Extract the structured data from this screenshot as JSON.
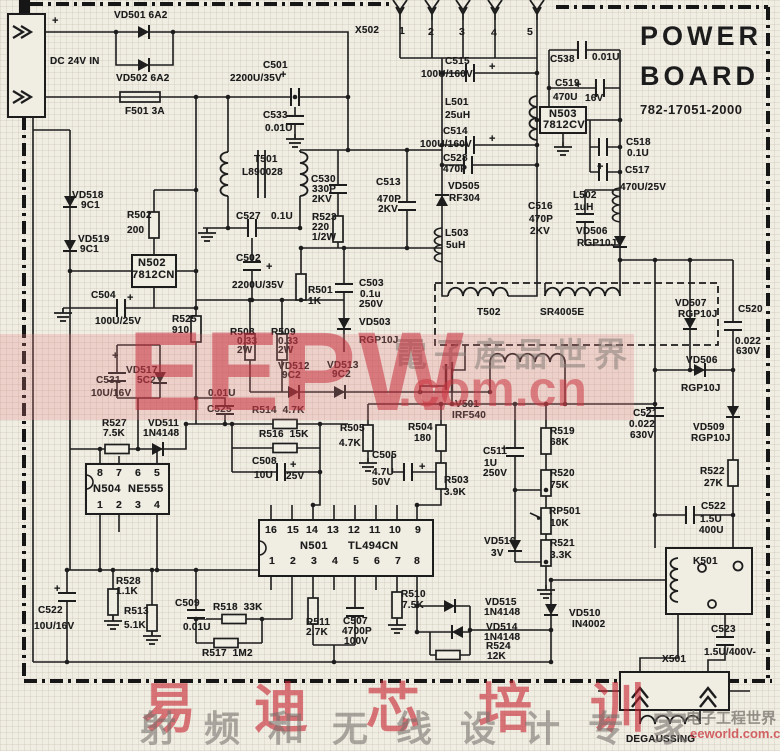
{
  "colors": {
    "paper": "#f0ede3",
    "ink": "#1d1d1d",
    "watermark_red": "#c52a3a",
    "watermark_pink": "rgba(226,128,128,0.26)"
  },
  "title_block": {
    "line1": "POWER",
    "line2": "BOARD",
    "part_number": "782-17051-2000"
  },
  "watermarks": {
    "center": {
      "brand": "EEPW",
      "cjk": "電子産品世界",
      "domain": ".com.cn"
    },
    "bottom": {
      "brand_cjk": "易迪芯培训",
      "slogan_cjk": "射频和无线设计专家",
      "site_cjk": "电子工程世界",
      "site_url": "eeworld.com.cn"
    }
  },
  "schematic": {
    "labels": [
      {
        "t": "+",
        "x": 52,
        "y": 16,
        "c": "plus"
      },
      {
        "t": "VD501 6A2",
        "x": 114,
        "y": 11
      },
      {
        "t": "DC 24V IN",
        "x": 50,
        "y": 57
      },
      {
        "t": "VD502 6A2",
        "x": 116,
        "y": 74
      },
      {
        "t": "F501 3A",
        "x": 125,
        "y": 107
      },
      {
        "t": "X502",
        "x": 355,
        "y": 26
      },
      {
        "t": "1",
        "x": 399,
        "y": 26,
        "c": "p"
      },
      {
        "t": "2",
        "x": 428,
        "y": 27,
        "c": "p"
      },
      {
        "t": "3",
        "x": 459,
        "y": 27,
        "c": "p"
      },
      {
        "t": "4",
        "x": 491,
        "y": 28,
        "c": "p"
      },
      {
        "t": "5",
        "x": 527,
        "y": 27,
        "c": "p"
      },
      {
        "t": "C538",
        "x": 550,
        "y": 55
      },
      {
        "t": "0.01U",
        "x": 592,
        "y": 53
      },
      {
        "t": "C519",
        "x": 555,
        "y": 79
      },
      {
        "t": "+",
        "x": 575,
        "y": 80,
        "c": "plus"
      },
      {
        "t": "470U",
        "x": 553,
        "y": 93
      },
      {
        "t": "16V",
        "x": 585,
        "y": 94
      },
      {
        "t": "N503",
        "x": 549,
        "y": 109,
        "c": "ic"
      },
      {
        "t": "7812CV",
        "x": 543,
        "y": 120,
        "c": "ic"
      },
      {
        "t": "C518",
        "x": 626,
        "y": 138
      },
      {
        "t": "0.1U",
        "x": 627,
        "y": 149
      },
      {
        "t": "C517",
        "x": 625,
        "y": 166
      },
      {
        "t": "+",
        "x": 597,
        "y": 162,
        "c": "plus"
      },
      {
        "t": "470U/25V",
        "x": 620,
        "y": 183
      },
      {
        "t": "C515",
        "x": 445,
        "y": 57
      },
      {
        "t": "100U/160V",
        "x": 421,
        "y": 70
      },
      {
        "t": "+",
        "x": 489,
        "y": 62,
        "c": "plus"
      },
      {
        "t": "L501",
        "x": 445,
        "y": 98
      },
      {
        "t": "25uH",
        "x": 445,
        "y": 111
      },
      {
        "t": "C514",
        "x": 443,
        "y": 127
      },
      {
        "t": "100U/160V",
        "x": 420,
        "y": 140
      },
      {
        "t": "+",
        "x": 489,
        "y": 134,
        "c": "plus"
      },
      {
        "t": "C528",
        "x": 443,
        "y": 154
      },
      {
        "t": "470P",
        "x": 443,
        "y": 165
      },
      {
        "t": "VD505",
        "x": 448,
        "y": 182
      },
      {
        "t": "RF304",
        "x": 449,
        "y": 194
      },
      {
        "t": "L503",
        "x": 445,
        "y": 229
      },
      {
        "t": "5uH",
        "x": 446,
        "y": 241
      },
      {
        "t": "C516",
        "x": 528,
        "y": 202
      },
      {
        "t": "470P",
        "x": 529,
        "y": 215
      },
      {
        "t": "2KV",
        "x": 530,
        "y": 227
      },
      {
        "t": "L502",
        "x": 573,
        "y": 191
      },
      {
        "t": "1uH",
        "x": 574,
        "y": 203
      },
      {
        "t": "VD506",
        "x": 576,
        "y": 227
      },
      {
        "t": "RGP10J",
        "x": 577,
        "y": 239
      },
      {
        "t": "C501",
        "x": 263,
        "y": 61
      },
      {
        "t": "2200U/35V",
        "x": 230,
        "y": 74
      },
      {
        "t": "+",
        "x": 280,
        "y": 70,
        "c": "plus"
      },
      {
        "t": "C533",
        "x": 263,
        "y": 111
      },
      {
        "t": "0.01U",
        "x": 265,
        "y": 124
      },
      {
        "t": "T501",
        "x": 254,
        "y": 155
      },
      {
        "t": "L890028",
        "x": 242,
        "y": 168
      },
      {
        "t": "C530",
        "x": 311,
        "y": 175
      },
      {
        "t": "330P",
        "x": 312,
        "y": 185
      },
      {
        "t": "2KV",
        "x": 312,
        "y": 195
      },
      {
        "t": "C513",
        "x": 376,
        "y": 178
      },
      {
        "t": "470P",
        "x": 377,
        "y": 195
      },
      {
        "t": "2KV",
        "x": 378,
        "y": 205
      },
      {
        "t": "VD518",
        "x": 72,
        "y": 191
      },
      {
        "t": "9C1",
        "x": 81,
        "y": 201
      },
      {
        "t": "VD519",
        "x": 78,
        "y": 235
      },
      {
        "t": "9C1",
        "x": 80,
        "y": 245
      },
      {
        "t": "R502",
        "x": 127,
        "y": 211
      },
      {
        "t": "200",
        "x": 127,
        "y": 226
      },
      {
        "t": "C527",
        "x": 236,
        "y": 212
      },
      {
        "t": "0.1U",
        "x": 271,
        "y": 212
      },
      {
        "t": "R523",
        "x": 312,
        "y": 213
      },
      {
        "t": "220",
        "x": 312,
        "y": 223
      },
      {
        "t": "1/2W",
        "x": 312,
        "y": 233
      },
      {
        "t": "N502",
        "x": 138,
        "y": 258,
        "c": "ic"
      },
      {
        "t": "7812CN",
        "x": 132,
        "y": 270,
        "c": "ic"
      },
      {
        "t": "C502",
        "x": 236,
        "y": 254
      },
      {
        "t": "+",
        "x": 266,
        "y": 262,
        "c": "plus"
      },
      {
        "t": "2200U/35V",
        "x": 232,
        "y": 281
      },
      {
        "t": "R501",
        "x": 308,
        "y": 286
      },
      {
        "t": "1K",
        "x": 308,
        "y": 297
      },
      {
        "t": "C503",
        "x": 359,
        "y": 279
      },
      {
        "t": "0.1u",
        "x": 360,
        "y": 290
      },
      {
        "t": "250V",
        "x": 359,
        "y": 300
      },
      {
        "t": "C504",
        "x": 91,
        "y": 291
      },
      {
        "t": "+",
        "x": 127,
        "y": 293,
        "c": "plus"
      },
      {
        "t": "100U/25V",
        "x": 95,
        "y": 317
      },
      {
        "t": "R525",
        "x": 172,
        "y": 315
      },
      {
        "t": "910",
        "x": 172,
        "y": 326
      },
      {
        "t": "VD503",
        "x": 359,
        "y": 318
      },
      {
        "t": "RGP10J",
        "x": 359,
        "y": 336
      },
      {
        "t": "T502",
        "x": 477,
        "y": 308
      },
      {
        "t": "SR4005E",
        "x": 540,
        "y": 308
      },
      {
        "t": "R508",
        "x": 230,
        "y": 328
      },
      {
        "t": "0.33",
        "x": 237,
        "y": 337
      },
      {
        "t": "2W",
        "x": 237,
        "y": 346
      },
      {
        "t": "R509",
        "x": 271,
        "y": 328
      },
      {
        "t": "0.33",
        "x": 278,
        "y": 337
      },
      {
        "t": "2W",
        "x": 278,
        "y": 346
      },
      {
        "t": "VD512",
        "x": 278,
        "y": 362
      },
      {
        "t": "9C2",
        "x": 282,
        "y": 371
      },
      {
        "t": "VD513",
        "x": 327,
        "y": 361
      },
      {
        "t": "9C2",
        "x": 332,
        "y": 370
      },
      {
        "t": "C531",
        "x": 96,
        "y": 376
      },
      {
        "t": "10U/16V",
        "x": 91,
        "y": 389
      },
      {
        "t": "+",
        "x": 112,
        "y": 351,
        "c": "plus"
      },
      {
        "t": "VD517",
        "x": 126,
        "y": 366
      },
      {
        "t": "5C2",
        "x": 137,
        "y": 376
      },
      {
        "t": "0.01U",
        "x": 208,
        "y": 389
      },
      {
        "t": "C525",
        "x": 207,
        "y": 405
      },
      {
        "t": "R514  4.7K",
        "x": 252,
        "y": 406
      },
      {
        "t": "R516  15K",
        "x": 259,
        "y": 430
      },
      {
        "t": "V501",
        "x": 455,
        "y": 400
      },
      {
        "t": "IRF540",
        "x": 452,
        "y": 411
      },
      {
        "t": "R527",
        "x": 102,
        "y": 419
      },
      {
        "t": "7.5K",
        "x": 103,
        "y": 429
      },
      {
        "t": "VD511",
        "x": 148,
        "y": 419
      },
      {
        "t": "1N4148",
        "x": 143,
        "y": 429
      },
      {
        "t": "R505",
        "x": 340,
        "y": 424
      },
      {
        "t": "4.7K",
        "x": 339,
        "y": 439
      },
      {
        "t": "R504",
        "x": 408,
        "y": 423
      },
      {
        "t": "180",
        "x": 414,
        "y": 434
      },
      {
        "t": "C505",
        "x": 372,
        "y": 451
      },
      {
        "t": "4.7U",
        "x": 372,
        "y": 468
      },
      {
        "t": "50V",
        "x": 372,
        "y": 478
      },
      {
        "t": "+",
        "x": 419,
        "y": 462,
        "c": "plus"
      },
      {
        "t": "R503",
        "x": 444,
        "y": 476
      },
      {
        "t": "3.9K",
        "x": 444,
        "y": 488
      },
      {
        "t": "C508",
        "x": 252,
        "y": 457
      },
      {
        "t": "+",
        "x": 290,
        "y": 460,
        "c": "plus"
      },
      {
        "t": "10U",
        "x": 254,
        "y": 471
      },
      {
        "t": "25V",
        "x": 286,
        "y": 472
      },
      {
        "t": "8",
        "x": 97,
        "y": 468,
        "c": "p"
      },
      {
        "t": "7",
        "x": 116,
        "y": 468,
        "c": "p"
      },
      {
        "t": "6",
        "x": 135,
        "y": 468,
        "c": "p"
      },
      {
        "t": "5",
        "x": 154,
        "y": 468,
        "c": "p"
      },
      {
        "t": "N504",
        "x": 93,
        "y": 484,
        "c": "ic"
      },
      {
        "t": "NE555",
        "x": 128,
        "y": 484,
        "c": "ic"
      },
      {
        "t": "1",
        "x": 97,
        "y": 500,
        "c": "p"
      },
      {
        "t": "2",
        "x": 116,
        "y": 500,
        "c": "p"
      },
      {
        "t": "3",
        "x": 135,
        "y": 500,
        "c": "p"
      },
      {
        "t": "4",
        "x": 154,
        "y": 500,
        "c": "p"
      },
      {
        "t": "VD507",
        "x": 675,
        "y": 299
      },
      {
        "t": "RGP10J",
        "x": 678,
        "y": 310
      },
      {
        "t": "C520",
        "x": 738,
        "y": 305
      },
      {
        "t": "0.022",
        "x": 735,
        "y": 337
      },
      {
        "t": "630V",
        "x": 736,
        "y": 347
      },
      {
        "t": "VD506",
        "x": 686,
        "y": 356
      },
      {
        "t": "RGP10J",
        "x": 681,
        "y": 384
      },
      {
        "t": "C521",
        "x": 633,
        "y": 409
      },
      {
        "t": "0.022",
        "x": 629,
        "y": 420
      },
      {
        "t": "630V",
        "x": 630,
        "y": 431
      },
      {
        "t": "VD509",
        "x": 693,
        "y": 423
      },
      {
        "t": "RGP10J",
        "x": 691,
        "y": 434
      },
      {
        "t": "R519",
        "x": 550,
        "y": 427
      },
      {
        "t": "68K",
        "x": 550,
        "y": 438
      },
      {
        "t": "C511",
        "x": 483,
        "y": 447
      },
      {
        "t": "+",
        "x": 501,
        "y": 444,
        "c": "plus"
      },
      {
        "t": "1U",
        "x": 484,
        "y": 459
      },
      {
        "t": "250V",
        "x": 483,
        "y": 469
      },
      {
        "t": "R520",
        "x": 550,
        "y": 469
      },
      {
        "t": "75K",
        "x": 550,
        "y": 481
      },
      {
        "t": "RP501",
        "x": 549,
        "y": 507
      },
      {
        "t": "10K",
        "x": 550,
        "y": 519
      },
      {
        "t": "VD516",
        "x": 484,
        "y": 537
      },
      {
        "t": "3V",
        "x": 491,
        "y": 549
      },
      {
        "t": "R521",
        "x": 550,
        "y": 539
      },
      {
        "t": "3.3K",
        "x": 550,
        "y": 551
      },
      {
        "t": "R522",
        "x": 700,
        "y": 467
      },
      {
        "t": "27K",
        "x": 704,
        "y": 479
      },
      {
        "t": "C522",
        "x": 701,
        "y": 502
      },
      {
        "t": "1.5U",
        "x": 700,
        "y": 515
      },
      {
        "t": "400U",
        "x": 699,
        "y": 526
      },
      {
        "t": "K501",
        "x": 693,
        "y": 557
      },
      {
        "t": "16",
        "x": 265,
        "y": 525,
        "c": "p"
      },
      {
        "t": "15",
        "x": 287,
        "y": 525,
        "c": "p"
      },
      {
        "t": "14",
        "x": 306,
        "y": 525,
        "c": "p"
      },
      {
        "t": "13",
        "x": 327,
        "y": 525,
        "c": "p"
      },
      {
        "t": "12",
        "x": 348,
        "y": 525,
        "c": "p"
      },
      {
        "t": "11",
        "x": 369,
        "y": 525,
        "c": "p"
      },
      {
        "t": "10",
        "x": 389,
        "y": 525,
        "c": "p"
      },
      {
        "t": "9",
        "x": 415,
        "y": 525,
        "c": "p"
      },
      {
        "t": "N501",
        "x": 300,
        "y": 541,
        "c": "ic"
      },
      {
        "t": "TL494CN",
        "x": 348,
        "y": 541,
        "c": "ic"
      },
      {
        "t": "1",
        "x": 269,
        "y": 556,
        "c": "p"
      },
      {
        "t": "2",
        "x": 290,
        "y": 556,
        "c": "p"
      },
      {
        "t": "3",
        "x": 311,
        "y": 556,
        "c": "p"
      },
      {
        "t": "4",
        "x": 332,
        "y": 556,
        "c": "p"
      },
      {
        "t": "5",
        "x": 353,
        "y": 556,
        "c": "p"
      },
      {
        "t": "6",
        "x": 374,
        "y": 556,
        "c": "p"
      },
      {
        "t": "7",
        "x": 395,
        "y": 556,
        "c": "p"
      },
      {
        "t": "8",
        "x": 414,
        "y": 556,
        "c": "p"
      },
      {
        "t": "R528",
        "x": 116,
        "y": 577
      },
      {
        "t": "1.1K",
        "x": 116,
        "y": 587
      },
      {
        "t": "C522",
        "x": 38,
        "y": 606
      },
      {
        "t": "10U/16V",
        "x": 34,
        "y": 622
      },
      {
        "t": "+",
        "x": 54,
        "y": 584,
        "c": "plus"
      },
      {
        "t": "R513",
        "x": 124,
        "y": 607
      },
      {
        "t": "5.1K",
        "x": 124,
        "y": 621
      },
      {
        "t": "C509",
        "x": 175,
        "y": 599
      },
      {
        "t": "0.01U",
        "x": 183,
        "y": 623
      },
      {
        "t": "R518  33K",
        "x": 213,
        "y": 603
      },
      {
        "t": "R517  1M2",
        "x": 202,
        "y": 649
      },
      {
        "t": "R511",
        "x": 306,
        "y": 618
      },
      {
        "t": "2.7K",
        "x": 306,
        "y": 628
      },
      {
        "t": "C507",
        "x": 343,
        "y": 617
      },
      {
        "t": "4700P",
        "x": 342,
        "y": 627
      },
      {
        "t": "100V",
        "x": 344,
        "y": 637
      },
      {
        "t": "R510",
        "x": 401,
        "y": 590
      },
      {
        "t": "7.5K",
        "x": 402,
        "y": 601
      },
      {
        "t": "VD515",
        "x": 485,
        "y": 598
      },
      {
        "t": "1N4148",
        "x": 484,
        "y": 608
      },
      {
        "t": "VD514",
        "x": 486,
        "y": 623
      },
      {
        "t": "1N4148",
        "x": 484,
        "y": 633
      },
      {
        "t": "R524",
        "x": 486,
        "y": 642
      },
      {
        "t": "12K",
        "x": 487,
        "y": 652
      },
      {
        "t": "VD510",
        "x": 569,
        "y": 609
      },
      {
        "t": "IN4002",
        "x": 572,
        "y": 620
      },
      {
        "t": "C523",
        "x": 711,
        "y": 625
      },
      {
        "t": "1.5U/400V-",
        "x": 704,
        "y": 648
      },
      {
        "t": "X501",
        "x": 662,
        "y": 655
      },
      {
        "t": "DEGAUSSING",
        "x": 626,
        "y": 735
      }
    ]
  }
}
